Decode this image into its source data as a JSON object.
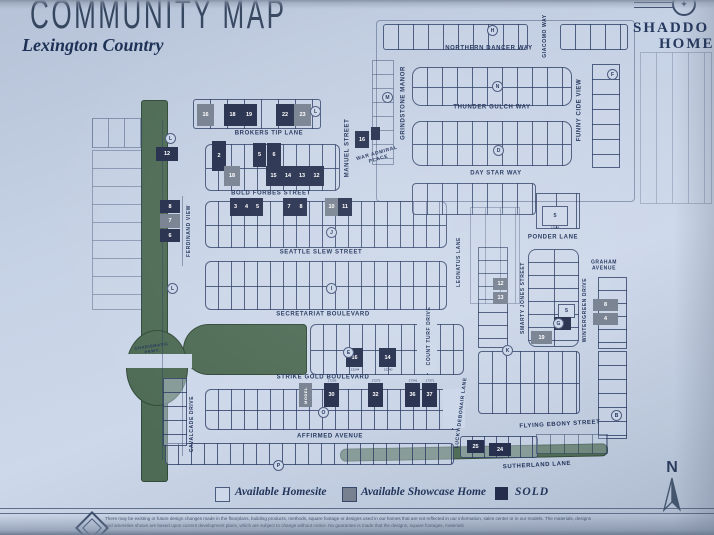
{
  "header": {
    "title": "COMMUNITY MAP",
    "subtitle": "Lexington Country",
    "brand_line1": "SHADDO",
    "brand_line2": "HOME",
    "brand_emblem": "globe-star-emblem"
  },
  "legend": {
    "available_label": "Available Homesite",
    "showcase_label": "Available Showcase Home",
    "sold_label": "SOLD",
    "available_color": "#cdd8ea",
    "showcase_color": "#76808f",
    "sold_color": "#242e4c"
  },
  "compass": {
    "north_label": "N"
  },
  "disclaimer": {
    "line1": "There may be existing or future design changes made in the floorplans, building products, methods, square footage or designs used in our homes that are not reflected in our information, sales center or in our models. The materials, designs",
    "line2": "and amenities shown are based upon current development plans, which are subject to change without notice. No guarantee is made that the designs, square footages, materials"
  },
  "map": {
    "green_color": "#4e6b55",
    "streets": [
      {
        "name": "NORTHERN DANCER WAY",
        "cx": 489,
        "cy": 49,
        "rot": 0
      },
      {
        "name": "GIACOMO WAY",
        "cx": 546,
        "cy": 36,
        "rot": -90,
        "fs": 5
      },
      {
        "name": "THUNDER GULCH WAY",
        "cx": 492,
        "cy": 108,
        "rot": 0
      },
      {
        "name": "GRINDSTONE MANOR",
        "cx": 404,
        "cy": 103,
        "rot": -90
      },
      {
        "name": "FUNNY CIDE VIEW",
        "cx": 580,
        "cy": 110,
        "rot": -90
      },
      {
        "name": "DAY STAR WAY",
        "cx": 496,
        "cy": 174,
        "rot": 0
      },
      {
        "name": "BROKERS TIP LANE",
        "cx": 269,
        "cy": 134,
        "rot": 0
      },
      {
        "name": "MANUEL STREET",
        "cx": 348,
        "cy": 148,
        "rot": -90
      },
      {
        "name": "WAR ADMIRAL\nPLACE",
        "cx": 378,
        "cy": 157,
        "rot": -16,
        "fs": 5
      },
      {
        "name": "BOLD FORBES STREET",
        "cx": 271,
        "cy": 194,
        "rot": 0
      },
      {
        "name": "FERDINAND VIEW",
        "cx": 190,
        "cy": 231,
        "rot": -90,
        "fs": 5
      },
      {
        "name": "SEATTLE SLEW STREET",
        "cx": 321,
        "cy": 253,
        "rot": 0
      },
      {
        "name": "SECRETARIAT BOULEVARD",
        "cx": 323,
        "cy": 315,
        "rot": 0
      },
      {
        "name": "PONDER LANE",
        "cx": 553,
        "cy": 238,
        "rot": 0
      },
      {
        "name": "GRAHAM\nAVENUE",
        "cx": 604,
        "cy": 266,
        "rot": 0,
        "fs": 5
      },
      {
        "name": "LEONATUS LANE",
        "cx": 460,
        "cy": 262,
        "rot": -90,
        "fs": 5
      },
      {
        "name": "SMARTY JONES STREET",
        "cx": 524,
        "cy": 298,
        "rot": -90,
        "fs": 5
      },
      {
        "name": "WINTERGREEN DRIVE",
        "cx": 586,
        "cy": 310,
        "rot": -90,
        "fs": 5
      },
      {
        "name": "COUNT TURF DRIVE",
        "cx": 430,
        "cy": 336,
        "rot": -90,
        "fs": 5
      },
      {
        "name": "STRIKE GOLD BOULEVARD",
        "cx": 323,
        "cy": 378,
        "rot": 0
      },
      {
        "name": "CHARISMATIC\nPKWY.",
        "cx": 152,
        "cy": 349,
        "rot": -8,
        "fs": 4
      },
      {
        "name": "LUCKY DEBONAIR LANE",
        "cx": 462,
        "cy": 413,
        "rot": -83,
        "fs": 5
      },
      {
        "name": "CAVALCADE DRIVE",
        "cx": 193,
        "cy": 424,
        "rot": -90,
        "fs": 5
      },
      {
        "name": "AFFIRMED AVENUE",
        "cx": 330,
        "cy": 437,
        "rot": 0
      },
      {
        "name": "FLYING EBONY STREET",
        "cx": 560,
        "cy": 425,
        "rot": -3
      },
      {
        "name": "SUTHERLAND LANE",
        "cx": 537,
        "cy": 466,
        "rot": -3
      }
    ],
    "markers": [
      {
        "letter": "H",
        "x": 487,
        "y": 25
      },
      {
        "letter": "N",
        "x": 492,
        "y": 81
      },
      {
        "letter": "F",
        "x": 607,
        "y": 69
      },
      {
        "letter": "M",
        "x": 382,
        "y": 92
      },
      {
        "letter": "D",
        "x": 493,
        "y": 145
      },
      {
        "letter": "L",
        "x": 165,
        "y": 133
      },
      {
        "letter": "L",
        "x": 310,
        "y": 106
      },
      {
        "letter": "L",
        "x": 167,
        "y": 283
      },
      {
        "letter": "J",
        "x": 326,
        "y": 227
      },
      {
        "letter": "I",
        "x": 326,
        "y": 283
      },
      {
        "letter": "E",
        "x": 343,
        "y": 347
      },
      {
        "letter": "O",
        "x": 318,
        "y": 407
      },
      {
        "letter": "P",
        "x": 273,
        "y": 460
      },
      {
        "letter": "G",
        "x": 553,
        "y": 318
      },
      {
        "letter": "K",
        "x": 502,
        "y": 345
      },
      {
        "letter": "B",
        "x": 611,
        "y": 410
      }
    ],
    "lots": [
      {
        "n": "16",
        "t": "g",
        "x": 197,
        "y": 104,
        "w": 17,
        "h": 22
      },
      {
        "n": "18",
        "t": "s",
        "x": 224,
        "y": 104,
        "w": 17,
        "h": 22
      },
      {
        "n": "19",
        "t": "s",
        "x": 241,
        "y": 104,
        "w": 16,
        "h": 22
      },
      {
        "n": "22",
        "t": "s",
        "x": 276,
        "y": 104,
        "w": 18,
        "h": 22
      },
      {
        "n": "23",
        "t": "g",
        "x": 294,
        "y": 104,
        "w": 17,
        "h": 22
      },
      {
        "n": "2",
        "t": "s",
        "x": 212,
        "y": 141,
        "w": 14,
        "h": 30
      },
      {
        "n": "5",
        "t": "s",
        "x": 253,
        "y": 143,
        "w": 13,
        "h": 24
      },
      {
        "n": "6",
        "t": "s",
        "x": 267,
        "y": 143,
        "w": 14,
        "h": 24
      },
      {
        "n": "18",
        "t": "g",
        "x": 224,
        "y": 166,
        "w": 16,
        "h": 20
      },
      {
        "n": "15",
        "t": "s",
        "x": 266,
        "y": 166,
        "w": 15,
        "h": 20
      },
      {
        "n": "14",
        "t": "s",
        "x": 281,
        "y": 166,
        "w": 14,
        "h": 20
      },
      {
        "n": "13",
        "t": "s",
        "x": 295,
        "y": 166,
        "w": 14,
        "h": 20
      },
      {
        "n": "12",
        "t": "s",
        "x": 309,
        "y": 166,
        "w": 15,
        "h": 20
      },
      {
        "n": "3",
        "t": "s",
        "x": 230,
        "y": 198,
        "w": 11,
        "h": 18
      },
      {
        "n": "4",
        "t": "s",
        "x": 241,
        "y": 198,
        "w": 11,
        "h": 18
      },
      {
        "n": "5",
        "t": "s",
        "x": 252,
        "y": 198,
        "w": 11,
        "h": 18
      },
      {
        "n": "7",
        "t": "s",
        "x": 283,
        "y": 198,
        "w": 12,
        "h": 18
      },
      {
        "n": "8",
        "t": "s",
        "x": 295,
        "y": 198,
        "w": 12,
        "h": 18
      },
      {
        "n": "10",
        "t": "g",
        "x": 325,
        "y": 198,
        "w": 13,
        "h": 18
      },
      {
        "n": "11",
        "t": "s",
        "x": 338,
        "y": 198,
        "w": 14,
        "h": 18
      },
      {
        "n": "12",
        "t": "s",
        "x": 156,
        "y": 147,
        "w": 22,
        "h": 14
      },
      {
        "n": "8",
        "t": "s",
        "x": 160,
        "y": 200,
        "w": 20,
        "h": 13
      },
      {
        "n": "7",
        "t": "g",
        "x": 160,
        "y": 214,
        "w": 20,
        "h": 14
      },
      {
        "n": "6",
        "t": "s",
        "x": 160,
        "y": 229,
        "w": 20,
        "h": 13
      },
      {
        "n": "16",
        "t": "s",
        "x": 355,
        "y": 131,
        "w": 14,
        "h": 17
      },
      {
        "n": "",
        "t": "s",
        "x": 371,
        "y": 127,
        "w": 9,
        "h": 13
      },
      {
        "n": "16",
        "t": "s",
        "x": 346,
        "y": 348,
        "w": 17,
        "h": 19,
        "a": "13244",
        "ap": "b"
      },
      {
        "n": "14",
        "t": "s",
        "x": 379,
        "y": 348,
        "w": 17,
        "h": 19,
        "a": "13240",
        "ap": "b"
      },
      {
        "n": "MODEL",
        "t": "g",
        "x": 299,
        "y": 383,
        "w": 13,
        "h": 24,
        "v": true
      },
      {
        "n": "30",
        "t": "s",
        "x": 324,
        "y": 383,
        "w": 15,
        "h": 24,
        "a": "17203",
        "ap": "t"
      },
      {
        "n": "32",
        "t": "s",
        "x": 368,
        "y": 383,
        "w": 15,
        "h": 24,
        "a": "17275",
        "ap": "t"
      },
      {
        "n": "36",
        "t": "s",
        "x": 405,
        "y": 383,
        "w": 15,
        "h": 24,
        "a": "17341",
        "ap": "t"
      },
      {
        "n": "37",
        "t": "s",
        "x": 422,
        "y": 383,
        "w": 15,
        "h": 24,
        "a": "17371",
        "ap": "t"
      },
      {
        "n": "5",
        "t": "a",
        "x": 542,
        "y": 206,
        "w": 24,
        "h": 18,
        "a": "13064",
        "ap": "b"
      },
      {
        "n": "12",
        "t": "g",
        "x": 493,
        "y": 278,
        "w": 15,
        "h": 12
      },
      {
        "n": "13",
        "t": "g",
        "x": 493,
        "y": 292,
        "w": 15,
        "h": 12
      },
      {
        "n": "5",
        "t": "a",
        "x": 558,
        "y": 304,
        "w": 15,
        "h": 12
      },
      {
        "n": "6",
        "t": "s",
        "x": 554,
        "y": 317,
        "w": 17,
        "h": 13
      },
      {
        "n": "19",
        "t": "g",
        "x": 531,
        "y": 331,
        "w": 21,
        "h": 13
      },
      {
        "n": "8",
        "t": "g",
        "x": 593,
        "y": 299,
        "w": 25,
        "h": 12
      },
      {
        "n": "4",
        "t": "g",
        "x": 593,
        "y": 313,
        "w": 25,
        "h": 12
      },
      {
        "n": "25",
        "t": "s",
        "x": 467,
        "y": 440,
        "w": 17,
        "h": 13
      },
      {
        "n": "24",
        "t": "s",
        "x": 489,
        "y": 443,
        "w": 22,
        "h": 13
      }
    ]
  }
}
